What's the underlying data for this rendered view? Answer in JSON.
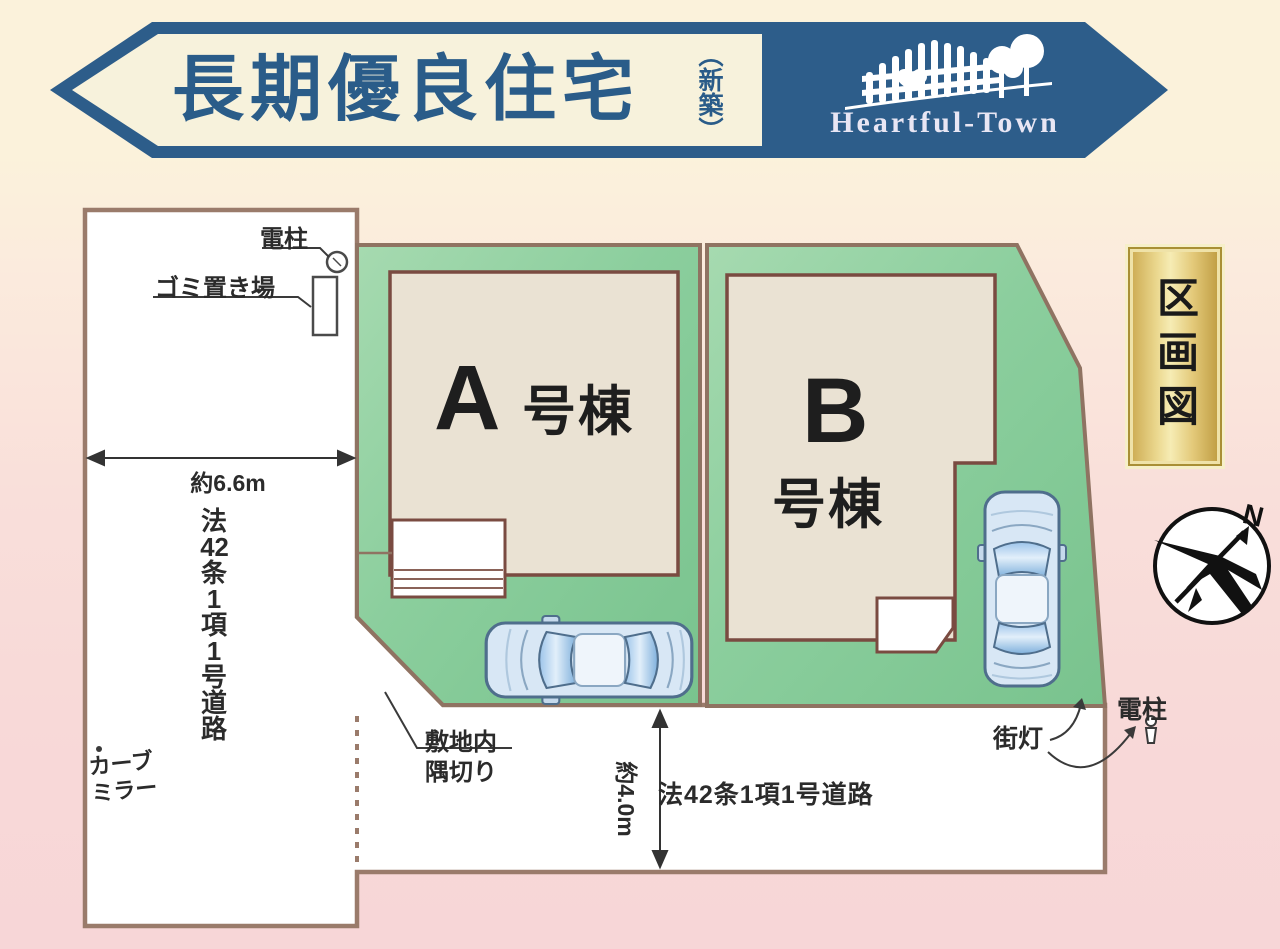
{
  "banner": {
    "title": "長期優良住宅",
    "subtitle": "（新築）",
    "brand": "Heartful-Town"
  },
  "plate": {
    "label": "区画図"
  },
  "compass": {
    "north": "N"
  },
  "lots": {
    "a": {
      "letter": "A",
      "suffix": "号棟"
    },
    "b": {
      "letter": "B",
      "suffix": "号棟"
    }
  },
  "labels": {
    "utility_pole_top": "電柱",
    "garbage": "ゴミ置き場",
    "width_west": "約6.6m",
    "road_west_chars": [
      "法",
      "42",
      "条",
      "1",
      "項",
      "1",
      "号",
      "道",
      "路"
    ],
    "curve_mirror_1": "カーブ",
    "curve_mirror_2": "ミラー",
    "setback_1": "敷地内",
    "setback_2": "隅切り",
    "width_south": "約4.0m",
    "road_south": "法42条1項1号道路",
    "street_light": "街灯",
    "utility_pole_right": "電柱"
  },
  "colors": {
    "banner_blue": "#2D5D8A",
    "banner_cream": "#F7F2DC",
    "title_blue": "#2A5C89",
    "brand_white": "#E8E6F4",
    "lot_green": "#8BCE9D",
    "building_beige": "#EAE2D3",
    "building_border": "#7A4B41",
    "road_white": "#FFFFFF",
    "road_border_brown": "#9A7B6B",
    "plate_gold": "#E3C979",
    "bg_cream": "#FBF2DB",
    "bg_pink": "#F7D6D7",
    "car_blue": "#C9DFF2"
  }
}
